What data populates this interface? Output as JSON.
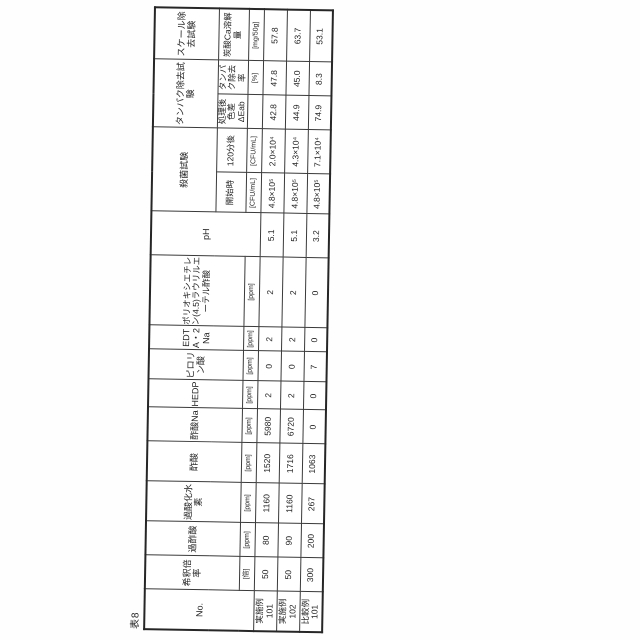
{
  "page": {
    "caption": "表8"
  },
  "table": {
    "h1": {
      "no": "No.",
      "dil": "希釈倍率",
      "paa": "過酢酸",
      "h2o2": "過酸化水素",
      "acoh": "酢酸",
      "acona": "酢酸Na",
      "hedp": "HEDP",
      "pyro": "ピロリン酸",
      "edta": "EDTA・2Na",
      "poe": "ポリオキシエチレン(4.5)ラウリルエーテル酢酸",
      "ph": "pH",
      "bact": "殺菌試験",
      "prot": "タンパク除去試験",
      "scale": "スケール除去試験"
    },
    "h2": {
      "bact_start": "開始時",
      "bact_120": "120分後",
      "prot_de": "処理後色差ΔEab",
      "prot_rate": "タンパク除去率",
      "scale_ca": "炭酸Ca溶解量"
    },
    "units": {
      "dil": "[倍]",
      "ppm": "[ppm]",
      "cfu": "[CFU/mL]",
      "pct": "[%]",
      "mg": "[mg/50g]"
    },
    "rows": [
      {
        "no": "実施例101",
        "v": [
          "50",
          "80",
          "1160",
          "1520",
          "5980",
          "2",
          "0",
          "2",
          "2",
          "5.1",
          "4.8×10⁵",
          "2.0×10⁴",
          "42.8",
          "47.8",
          "57.8"
        ]
      },
      {
        "no": "実施例102",
        "v": [
          "50",
          "90",
          "1160",
          "1716",
          "6720",
          "2",
          "0",
          "2",
          "2",
          "5.1",
          "4.8×10⁵",
          "4.3×10⁴",
          "44.9",
          "45.0",
          "63.7"
        ]
      },
      {
        "no": "比較例101",
        "v": [
          "300",
          "200",
          "267",
          "1063",
          "0",
          "0",
          "7",
          "0",
          "0",
          "3.2",
          "4.8×10⁵",
          "7.1×10⁴",
          "74.9",
          "8.3",
          "53.1"
        ]
      }
    ]
  }
}
